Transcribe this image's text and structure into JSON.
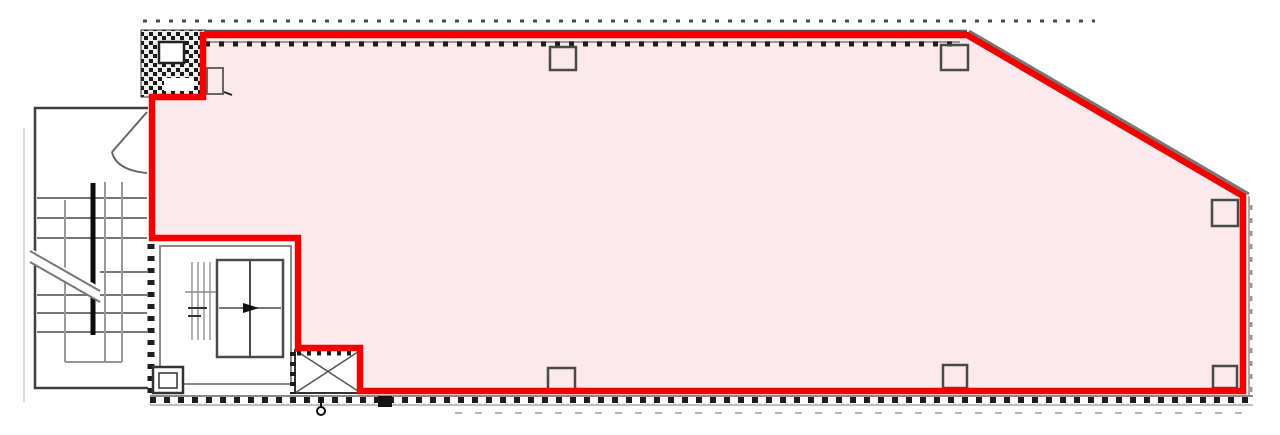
{
  "canvas": {
    "width": 1280,
    "height": 435,
    "background": "#ffffff"
  },
  "colors": {
    "highlight_red": "#F20000",
    "leased_area_pink": "#FBE9EB",
    "wall_dark": "#1e1e1e",
    "line_mid_grey": "#6b6b6b",
    "line_light_grey": "#aaaaaa",
    "background_white": "#ffffff"
  },
  "shapes": [
    {
      "name": "page-edge-line",
      "tag": "line",
      "attrs": {
        "x1": 24,
        "y1": 128,
        "x2": 24,
        "y2": 402,
        "stroke": "#dcdcdc",
        "stroke-width": 2
      }
    },
    {
      "name": "leased-area-fill",
      "tag": "polygon",
      "attrs": {
        "points": "203,35 967,35 1243,196 1243,391 360,391 360,348 298,348 298,238 152,238 152,97 203,97",
        "fill": "#FBE9EB",
        "stroke": "none"
      }
    },
    {
      "name": "top-dimension-dashes",
      "tag": "line",
      "attrs": {
        "x1": 143,
        "y1": 21,
        "x2": 1095,
        "y2": 21,
        "stroke": "#4a4a4a",
        "stroke-width": 3,
        "stroke-dasharray": "4 9"
      }
    },
    {
      "name": "top-wall-line",
      "tag": "line",
      "attrs": {
        "x1": 205,
        "y1": 31,
        "x2": 967,
        "y2": 31,
        "stroke": "#555555",
        "stroke-width": 2.5
      }
    },
    {
      "name": "diagonal-wall-line",
      "tag": "line",
      "attrs": {
        "x1": 969,
        "y1": 31,
        "x2": 1249,
        "y2": 194,
        "stroke": "#777777",
        "stroke-width": 3
      }
    },
    {
      "name": "right-wall-line",
      "tag": "line",
      "attrs": {
        "x1": 1249,
        "y1": 196,
        "x2": 1249,
        "y2": 396,
        "stroke": "#aaaaaa",
        "stroke-width": 2
      }
    },
    {
      "name": "right-wall-hatch",
      "tag": "line",
      "attrs": {
        "x1": 1251,
        "y1": 205,
        "x2": 1251,
        "y2": 396,
        "stroke": "#999999",
        "stroke-width": 3,
        "stroke-dasharray": "5 8"
      }
    },
    {
      "name": "top-wall-grey-face",
      "tag": "line",
      "attrs": {
        "x1": 205,
        "y1": 42,
        "x2": 960,
        "y2": 42,
        "stroke": "#9a9a9a",
        "stroke-width": 2
      }
    },
    {
      "name": "top-wall-hatch",
      "tag": "line",
      "attrs": {
        "x1": 205,
        "y1": 44,
        "x2": 958,
        "y2": 44,
        "stroke": "#1e1e1e",
        "stroke-width": 5,
        "stroke-dasharray": "5 9"
      }
    },
    {
      "name": "bottom-wall-grey-face-upper",
      "tag": "line",
      "attrs": {
        "x1": 150,
        "y1": 396,
        "x2": 1253,
        "y2": 396,
        "stroke": "#8a8a8a",
        "stroke-width": 2
      }
    },
    {
      "name": "bottom-wall-hatch",
      "tag": "line",
      "attrs": {
        "x1": 150,
        "y1": 400,
        "x2": 1253,
        "y2": 400,
        "stroke": "#1e1e1e",
        "stroke-width": 6,
        "stroke-dasharray": "6 8"
      }
    },
    {
      "name": "bottom-wall-grey-face-lower",
      "tag": "line",
      "attrs": {
        "x1": 150,
        "y1": 405,
        "x2": 1253,
        "y2": 405,
        "stroke": "#aaaaaa",
        "stroke-width": 1.5
      }
    },
    {
      "name": "bottom-dimension-dashes",
      "tag": "line",
      "attrs": {
        "x1": 455,
        "y1": 413,
        "x2": 1243,
        "y2": 413,
        "stroke": "#b5b5b5",
        "stroke-width": 2,
        "stroke-dasharray": "7 13"
      }
    },
    {
      "name": "core-left-wall-hatch",
      "tag": "line",
      "attrs": {
        "x1": 151,
        "y1": 244,
        "x2": 151,
        "y2": 396,
        "stroke": "#1e1e1e",
        "stroke-width": 7,
        "stroke-dasharray": "5 7"
      }
    },
    {
      "name": "shaft-hatch-block",
      "tag": "rect",
      "attrs": {
        "x": 141,
        "y": 30,
        "width": 64,
        "height": 67,
        "fill": "url(#denseHatch)",
        "stroke": "#333333",
        "stroke-width": 1
      }
    },
    {
      "name": "shaft-hatch-block-inner-square",
      "tag": "rect",
      "attrs": {
        "x": 159,
        "y": 42,
        "width": 25,
        "height": 21,
        "fill": "#ffffff",
        "stroke": "#222222",
        "stroke-width": 2.5
      }
    },
    {
      "name": "shaft-hatch-block-gap",
      "tag": "rect",
      "attrs": {
        "x": 164,
        "y": 78,
        "width": 30,
        "height": 13,
        "fill": "#ffffff"
      }
    },
    {
      "name": "wall-stub-rect",
      "tag": "rect",
      "attrs": {
        "x": 207,
        "y": 68,
        "width": 16,
        "height": 26,
        "fill": "none",
        "stroke": "#666666",
        "stroke-width": 2
      }
    },
    {
      "name": "wall-stub-tick",
      "tag": "line",
      "attrs": {
        "x1": 224,
        "y1": 92,
        "x2": 232,
        "y2": 95,
        "stroke": "#222222",
        "stroke-width": 2
      }
    },
    {
      "name": "stairwell-outline",
      "tag": "polyline",
      "attrs": {
        "points": "148,108 35,108 35,388 148,388",
        "fill": "none",
        "stroke": "#3f3f3f",
        "stroke-width": 2.5
      }
    },
    {
      "name": "entrance-door-leaf",
      "tag": "line",
      "attrs": {
        "x1": 147,
        "y1": 112,
        "x2": 112,
        "y2": 152,
        "stroke": "#666666",
        "stroke-width": 2
      }
    },
    {
      "name": "entrance-door-swing-arc",
      "tag": "path",
      "attrs": {
        "d": "M112,152 Q116,170 147,173",
        "fill": "none",
        "stroke": "#666666",
        "stroke-width": 2
      }
    },
    {
      "name": "stair-tread",
      "tag": "line",
      "attrs": {
        "x1": 37,
        "y1": 198,
        "x2": 147,
        "y2": 198,
        "stroke": "#777777",
        "stroke-width": 2
      }
    },
    {
      "name": "stair-tread",
      "tag": "line",
      "attrs": {
        "x1": 37,
        "y1": 218,
        "x2": 147,
        "y2": 218,
        "stroke": "#777777",
        "stroke-width": 2
      }
    },
    {
      "name": "stair-tread",
      "tag": "line",
      "attrs": {
        "x1": 37,
        "y1": 238,
        "x2": 147,
        "y2": 238,
        "stroke": "#777777",
        "stroke-width": 2
      }
    },
    {
      "name": "stair-tread",
      "tag": "line",
      "attrs": {
        "x1": 100,
        "y1": 272,
        "x2": 147,
        "y2": 272,
        "stroke": "#777777",
        "stroke-width": 2
      }
    },
    {
      "name": "stair-tread",
      "tag": "line",
      "attrs": {
        "x1": 37,
        "y1": 295,
        "x2": 147,
        "y2": 295,
        "stroke": "#777777",
        "stroke-width": 2
      }
    },
    {
      "name": "stair-tread",
      "tag": "line",
      "attrs": {
        "x1": 37,
        "y1": 313,
        "x2": 147,
        "y2": 313,
        "stroke": "#777777",
        "stroke-width": 2
      }
    },
    {
      "name": "stair-tread",
      "tag": "line",
      "attrs": {
        "x1": 37,
        "y1": 332,
        "x2": 147,
        "y2": 332,
        "stroke": "#777777",
        "stroke-width": 2
      }
    },
    {
      "name": "stair-flight-edge",
      "tag": "line",
      "attrs": {
        "x1": 65,
        "y1": 200,
        "x2": 65,
        "y2": 362,
        "stroke": "#999999",
        "stroke-width": 2
      }
    },
    {
      "name": "stair-flight-edge",
      "tag": "line",
      "attrs": {
        "x1": 105,
        "y1": 182,
        "x2": 105,
        "y2": 362,
        "stroke": "#999999",
        "stroke-width": 2
      }
    },
    {
      "name": "stair-flight-edge",
      "tag": "line",
      "attrs": {
        "x1": 122,
        "y1": 182,
        "x2": 122,
        "y2": 362,
        "stroke": "#999999",
        "stroke-width": 2
      }
    },
    {
      "name": "stair-landing-bottom",
      "tag": "line",
      "attrs": {
        "x1": 65,
        "y1": 362,
        "x2": 122,
        "y2": 362,
        "stroke": "#999999",
        "stroke-width": 2
      }
    },
    {
      "name": "stair-handrail",
      "tag": "line",
      "attrs": {
        "x1": 93,
        "y1": 183,
        "x2": 93,
        "y2": 335,
        "stroke": "#0d0d0d",
        "stroke-width": 5
      }
    },
    {
      "name": "stair-break-mask",
      "tag": "polygon",
      "attrs": {
        "points": "28,247 100,287 100,302 28,262",
        "fill": "#ffffff"
      }
    },
    {
      "name": "stair-break-line",
      "tag": "line",
      "attrs": {
        "x1": 30,
        "y1": 251,
        "x2": 100,
        "y2": 291,
        "stroke": "#777777",
        "stroke-width": 2
      }
    },
    {
      "name": "stair-break-line",
      "tag": "line",
      "attrs": {
        "x1": 30,
        "y1": 262,
        "x2": 100,
        "y2": 302,
        "stroke": "#777777",
        "stroke-width": 2
      }
    },
    {
      "name": "elevator-room-outline",
      "tag": "rect",
      "attrs": {
        "x": 160,
        "y": 246,
        "width": 131,
        "height": 138,
        "fill": "#ffffff",
        "stroke": "#8a8a8a",
        "stroke-width": 2
      }
    },
    {
      "name": "elevator-car",
      "tag": "rect",
      "attrs": {
        "x": 217,
        "y": 260,
        "width": 66,
        "height": 97,
        "fill": "#ffffff",
        "stroke": "#4a4a4a",
        "stroke-width": 2.5
      }
    },
    {
      "name": "elevator-door-centerline",
      "tag": "line",
      "attrs": {
        "x1": 250,
        "y1": 260,
        "x2": 250,
        "y2": 357,
        "stroke": "#4a4a4a",
        "stroke-width": 2
      }
    },
    {
      "name": "elevator-mid-line",
      "tag": "line",
      "attrs": {
        "x1": 219,
        "y1": 308,
        "x2": 281,
        "y2": 308,
        "stroke": "#4a4a4a",
        "stroke-width": 1.5
      }
    },
    {
      "name": "elevator-arrow",
      "tag": "polygon",
      "attrs": {
        "points": "243,303 259,308 243,313",
        "fill": "#111111"
      }
    },
    {
      "name": "elevator-guide-rail",
      "tag": "line",
      "attrs": {
        "x1": 192,
        "y1": 262,
        "x2": 192,
        "y2": 340,
        "stroke": "#999999",
        "stroke-width": 1.5
      }
    },
    {
      "name": "elevator-guide-rail",
      "tag": "line",
      "attrs": {
        "x1": 198,
        "y1": 262,
        "x2": 198,
        "y2": 340,
        "stroke": "#999999",
        "stroke-width": 1.5
      }
    },
    {
      "name": "elevator-guide-rail",
      "tag": "line",
      "attrs": {
        "x1": 204,
        "y1": 262,
        "x2": 204,
        "y2": 340,
        "stroke": "#999999",
        "stroke-width": 1.5
      }
    },
    {
      "name": "elevator-guide-rail",
      "tag": "line",
      "attrs": {
        "x1": 210,
        "y1": 262,
        "x2": 210,
        "y2": 340,
        "stroke": "#999999",
        "stroke-width": 1.5
      }
    },
    {
      "name": "elevator-guide-tick",
      "tag": "line",
      "attrs": {
        "x1": 185,
        "y1": 292,
        "x2": 216,
        "y2": 292,
        "stroke": "#888888",
        "stroke-width": 1.5
      }
    },
    {
      "name": "elevator-guide-tick",
      "tag": "line",
      "attrs": {
        "x1": 188,
        "y1": 308,
        "x2": 207,
        "y2": 308,
        "stroke": "#333333",
        "stroke-width": 2
      }
    },
    {
      "name": "elevator-guide-tick",
      "tag": "line",
      "attrs": {
        "x1": 188,
        "y1": 316,
        "x2": 201,
        "y2": 316,
        "stroke": "#333333",
        "stroke-width": 2
      }
    },
    {
      "name": "pit-room-outer",
      "tag": "rect",
      "attrs": {
        "x": 153,
        "y": 367,
        "width": 30,
        "height": 26,
        "fill": "#ffffff",
        "stroke": "#333333",
        "stroke-width": 2.5
      }
    },
    {
      "name": "pit-room-inner",
      "tag": "rect",
      "attrs": {
        "x": 159,
        "y": 373,
        "width": 18,
        "height": 15,
        "fill": "none",
        "stroke": "#333333",
        "stroke-width": 1.5
      }
    },
    {
      "name": "pipe-shaft-box",
      "tag": "rect",
      "attrs": {
        "x": 295,
        "y": 350,
        "width": 66,
        "height": 43,
        "fill": "#ffffff",
        "stroke": "#333333",
        "stroke-width": 2
      }
    },
    {
      "name": "pipe-shaft-diagonal",
      "tag": "line",
      "attrs": {
        "x1": 295,
        "y1": 350,
        "x2": 361,
        "y2": 393,
        "stroke": "#555555",
        "stroke-width": 1.5
      }
    },
    {
      "name": "pipe-shaft-diagonal",
      "tag": "line",
      "attrs": {
        "x1": 295,
        "y1": 393,
        "x2": 361,
        "y2": 350,
        "stroke": "#555555",
        "stroke-width": 1.5
      }
    },
    {
      "name": "pipe-shaft-top-hatch",
      "tag": "line",
      "attrs": {
        "x1": 297,
        "y1": 353,
        "x2": 361,
        "y2": 353,
        "stroke": "#1e1e1e",
        "stroke-width": 5,
        "stroke-dasharray": "4 6"
      }
    },
    {
      "name": "pipe-shaft-left-hatch",
      "tag": "line",
      "attrs": {
        "x1": 293,
        "y1": 352,
        "x2": 293,
        "y2": 394,
        "stroke": "#1e1e1e",
        "stroke-width": 6,
        "stroke-dasharray": "4 6"
      }
    },
    {
      "name": "survey-mark-stem",
      "tag": "line",
      "attrs": {
        "x1": 321,
        "y1": 398,
        "x2": 321,
        "y2": 407,
        "stroke": "#111111",
        "stroke-width": 2
      }
    },
    {
      "name": "survey-mark-circle",
      "tag": "circle",
      "attrs": {
        "cx": 321,
        "cy": 411,
        "r": 4,
        "fill": "#ffffff",
        "stroke": "#111111",
        "stroke-width": 2
      }
    },
    {
      "name": "black-square-marker",
      "tag": "rect",
      "attrs": {
        "x": 378,
        "y": 396,
        "width": 14,
        "height": 11,
        "fill": "#151515"
      }
    },
    {
      "name": "column",
      "tag": "rect",
      "attrs": {
        "x": 550,
        "y": 47,
        "width": 26,
        "height": 23,
        "fill": "none",
        "stroke": "#4a4a4a",
        "stroke-width": 2.5
      }
    },
    {
      "name": "column",
      "tag": "rect",
      "attrs": {
        "x": 941,
        "y": 45,
        "width": 27,
        "height": 25,
        "fill": "none",
        "stroke": "#4a4a4a",
        "stroke-width": 2.5
      }
    },
    {
      "name": "column",
      "tag": "rect",
      "attrs": {
        "x": 1212,
        "y": 200,
        "width": 26,
        "height": 26,
        "fill": "none",
        "stroke": "#4a4a4a",
        "stroke-width": 2.5
      }
    },
    {
      "name": "column",
      "tag": "rect",
      "attrs": {
        "x": 1213,
        "y": 366,
        "width": 24,
        "height": 22,
        "fill": "none",
        "stroke": "#4a4a4a",
        "stroke-width": 2.5
      }
    },
    {
      "name": "column",
      "tag": "rect",
      "attrs": {
        "x": 943,
        "y": 365,
        "width": 24,
        "height": 23,
        "fill": "none",
        "stroke": "#4a4a4a",
        "stroke-width": 2.5
      }
    },
    {
      "name": "column",
      "tag": "rect",
      "attrs": {
        "x": 548,
        "y": 368,
        "width": 27,
        "height": 22,
        "fill": "none",
        "stroke": "#4a4a4a",
        "stroke-width": 2.5
      }
    },
    {
      "name": "leased-area-outline",
      "tag": "polygon",
      "attrs": {
        "points": "203,35 967,35 1243,196 1243,391 360,391 360,348 298,348 298,238 152,238 152,97 203,97",
        "fill": "none",
        "stroke": "#F20000",
        "stroke-width": 6.5,
        "stroke-linejoin": "miter"
      }
    }
  ]
}
